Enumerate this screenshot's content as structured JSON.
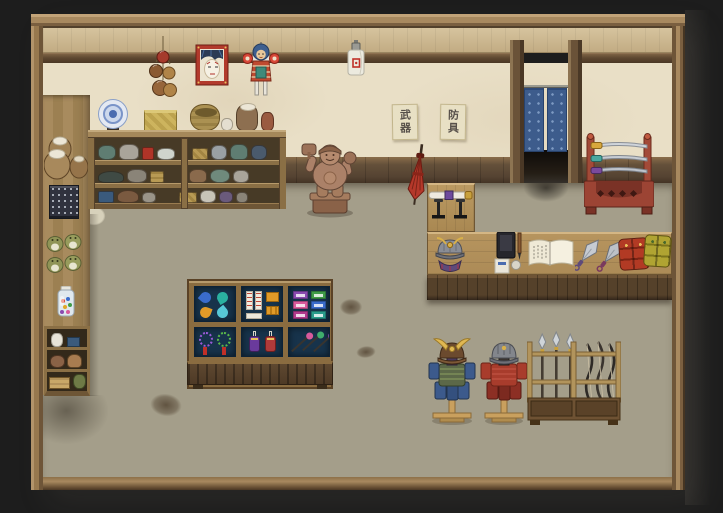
{
  "scene": {
    "title": "Weapon and armor shop interior - pixel RPG scene",
    "signs": {
      "weapons_scroll": "武器",
      "armor_scroll": "防具"
    }
  },
  "palette": {
    "backdrop": "#1d1d1d",
    "frame_wood": "#a8895f",
    "wall_plaster": "#e9dfc6",
    "wall_band": "#cdb893",
    "beam_dark": "#5e4830",
    "wainscot": "#6b563c",
    "floor_stone": "#d6d0ba",
    "floor_grout": "#a49e8a",
    "noren_blue": "#3f5f8e",
    "counter_wood": "#ad8c58",
    "case_interior": "#17334b",
    "rack_lacquer_red": "#9c4434",
    "statue_bronze": "#a8836b",
    "armor_blue": "#3c5a8c",
    "armor_red": "#a83c2c",
    "blade_steel": "#c9ced4",
    "accent_gold": "#d8b04a"
  },
  "objects": [
    {
      "id": "hanging-gourds",
      "label": "Hanging gourd cluster"
    },
    {
      "id": "kabuki-portrait",
      "label": "Framed kabuki portrait"
    },
    {
      "id": "hanging-doll",
      "label": "Hanging charm doll"
    },
    {
      "id": "wall-lantern",
      "label": "White wall lantern"
    },
    {
      "id": "weapons-scroll",
      "label": "Wall scroll: weapons"
    },
    {
      "id": "armor-scroll",
      "label": "Wall scroll: armor"
    },
    {
      "id": "doorway-noren",
      "label": "Doorway with blue noren curtain"
    },
    {
      "id": "red-umbrella",
      "label": "Closed red umbrella"
    },
    {
      "id": "merchant-statue",
      "label": "Wooden merchant-god statue"
    },
    {
      "id": "pottery-shelf",
      "label": "Pottery shelf"
    },
    {
      "id": "storage-jars",
      "label": "Cloth-topped storage jars"
    },
    {
      "id": "patterned-cloth",
      "label": "Stacked patterned cloth"
    },
    {
      "id": "frog-figurines",
      "label": "Frog figurines"
    },
    {
      "id": "candy-jar",
      "label": "Glass candy jar"
    },
    {
      "id": "side-shelf",
      "label": "Small side shelf"
    },
    {
      "id": "display-case",
      "label": "Glass goods display case"
    },
    {
      "id": "shop-counter",
      "label": "Shop counter"
    },
    {
      "id": "sheathed-katana-stand",
      "label": "Sheathed katana on stand"
    },
    {
      "id": "counter-kabuto",
      "label": "Samurai helmet on counter"
    },
    {
      "id": "calligraphy-set",
      "label": "Ink and brush set"
    },
    {
      "id": "open-ledger",
      "label": "Open ledger book"
    },
    {
      "id": "kunai-daggers",
      "label": "Pair of kunai"
    },
    {
      "id": "armor-bundle-red",
      "label": "Folded red armor"
    },
    {
      "id": "armor-bundle-yellow",
      "label": "Folded yellow armor"
    },
    {
      "id": "katana-rack",
      "label": "Lacquered katana rack"
    },
    {
      "id": "samurai-armor-horned",
      "label": "Horned samurai armor on stand"
    },
    {
      "id": "samurai-armor-red",
      "label": "Red samurai armor on stand"
    },
    {
      "id": "polearm-rack",
      "label": "Rack of spears and bows"
    },
    {
      "id": "floor-stains",
      "label": "Floor stains"
    }
  ]
}
